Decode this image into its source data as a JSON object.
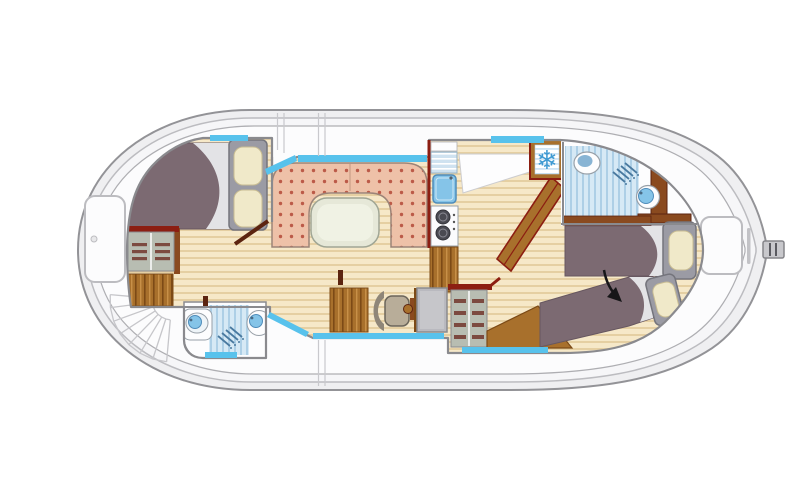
{
  "icons": {
    "freezer": "❄"
  },
  "scene": {
    "type": "boat-floor-plan",
    "orientation": "bow-right",
    "rooms": [
      "aft-deck-with-stairs",
      "aft-cabin-double-bed",
      "aft-bathroom",
      "saloon-dinette",
      "galley",
      "helm-station",
      "forward-bathroom",
      "bow-cabin-twin-beds",
      "foredeck"
    ],
    "furniture": [
      "double-bed",
      "wardrobe",
      "dinette-u-sofa",
      "table",
      "sink",
      "two-burner-stove",
      "fridge-freezer",
      "swivel-chair",
      "steering-wheel",
      "shelf-unit",
      "shower",
      "toilet",
      "washbasin",
      "twin-bed",
      "deck-hatch",
      "bow-cleat",
      "companionway-steps"
    ]
  },
  "colors": {
    "page_bg": "#ffffff",
    "hull_fill": "#efeff1",
    "hull_stroke": "#939397",
    "hull_inner_fill": "#f6f6f8",
    "hull_inner_stroke": "#bcbcc0",
    "deck_fill": "#fcfcfd",
    "deck_line": "#aeaeb2",
    "gate_line": "#c9c9cd",
    "stair_line": "#c6c6ca",
    "cabin_fill": "#fdfdfe",
    "wall_stroke": "#8a8a8e",
    "floor_base": "#f6e8c8",
    "floor_stripe": "#e5cfa2",
    "tile": "#d6e9f5",
    "tile_stripe": "#adcfe6",
    "sofa": "#eec1a8",
    "sofa_dot": "#bc5a48",
    "sofa_stroke": "#9c8478",
    "sofa_seam": "#d0a58e",
    "table_fill": "#e6e8d8",
    "table_inner": "#f0f2e4",
    "table_stroke": "#a0a695",
    "blanket": "#7c6a72",
    "blanket_stroke": "#675760",
    "sheet": "#e3e3e6",
    "pillow": "#f0e9c9",
    "pillow_stroke": "#c8bc92",
    "headboard": "#9b9ba4",
    "headboard_stroke": "#74747c",
    "wood_red": "#8c1e12",
    "wood_cabinet": "#a8702c",
    "wood_seam": "#7c4a16",
    "wood_door": "#5c2410",
    "vanity_brown": "#8a4a1f",
    "shelf_panel": "#b8bdb2",
    "shelf_bar": "#7c4a40",
    "fixture_fill": "#fdfdfe",
    "fixture_stroke": "#98a0a8",
    "basin": "#85c4e8",
    "basin_stroke": "#4f8cba",
    "drain_base": "#cfe2f0",
    "window": "#58c2ec",
    "fridge_stripe": "#cfe4f4",
    "snowflake": "#3f9ad2",
    "stove_burner": "#4a4a52",
    "stove_ring": "#8a8a94",
    "chair_seat": "#b8ad99",
    "chair_back": "#8f8678",
    "chair_stroke": "#6b655a",
    "console": "#b9b9bf",
    "shower_icon": "#4a7aa0",
    "arrow": "#161618"
  }
}
